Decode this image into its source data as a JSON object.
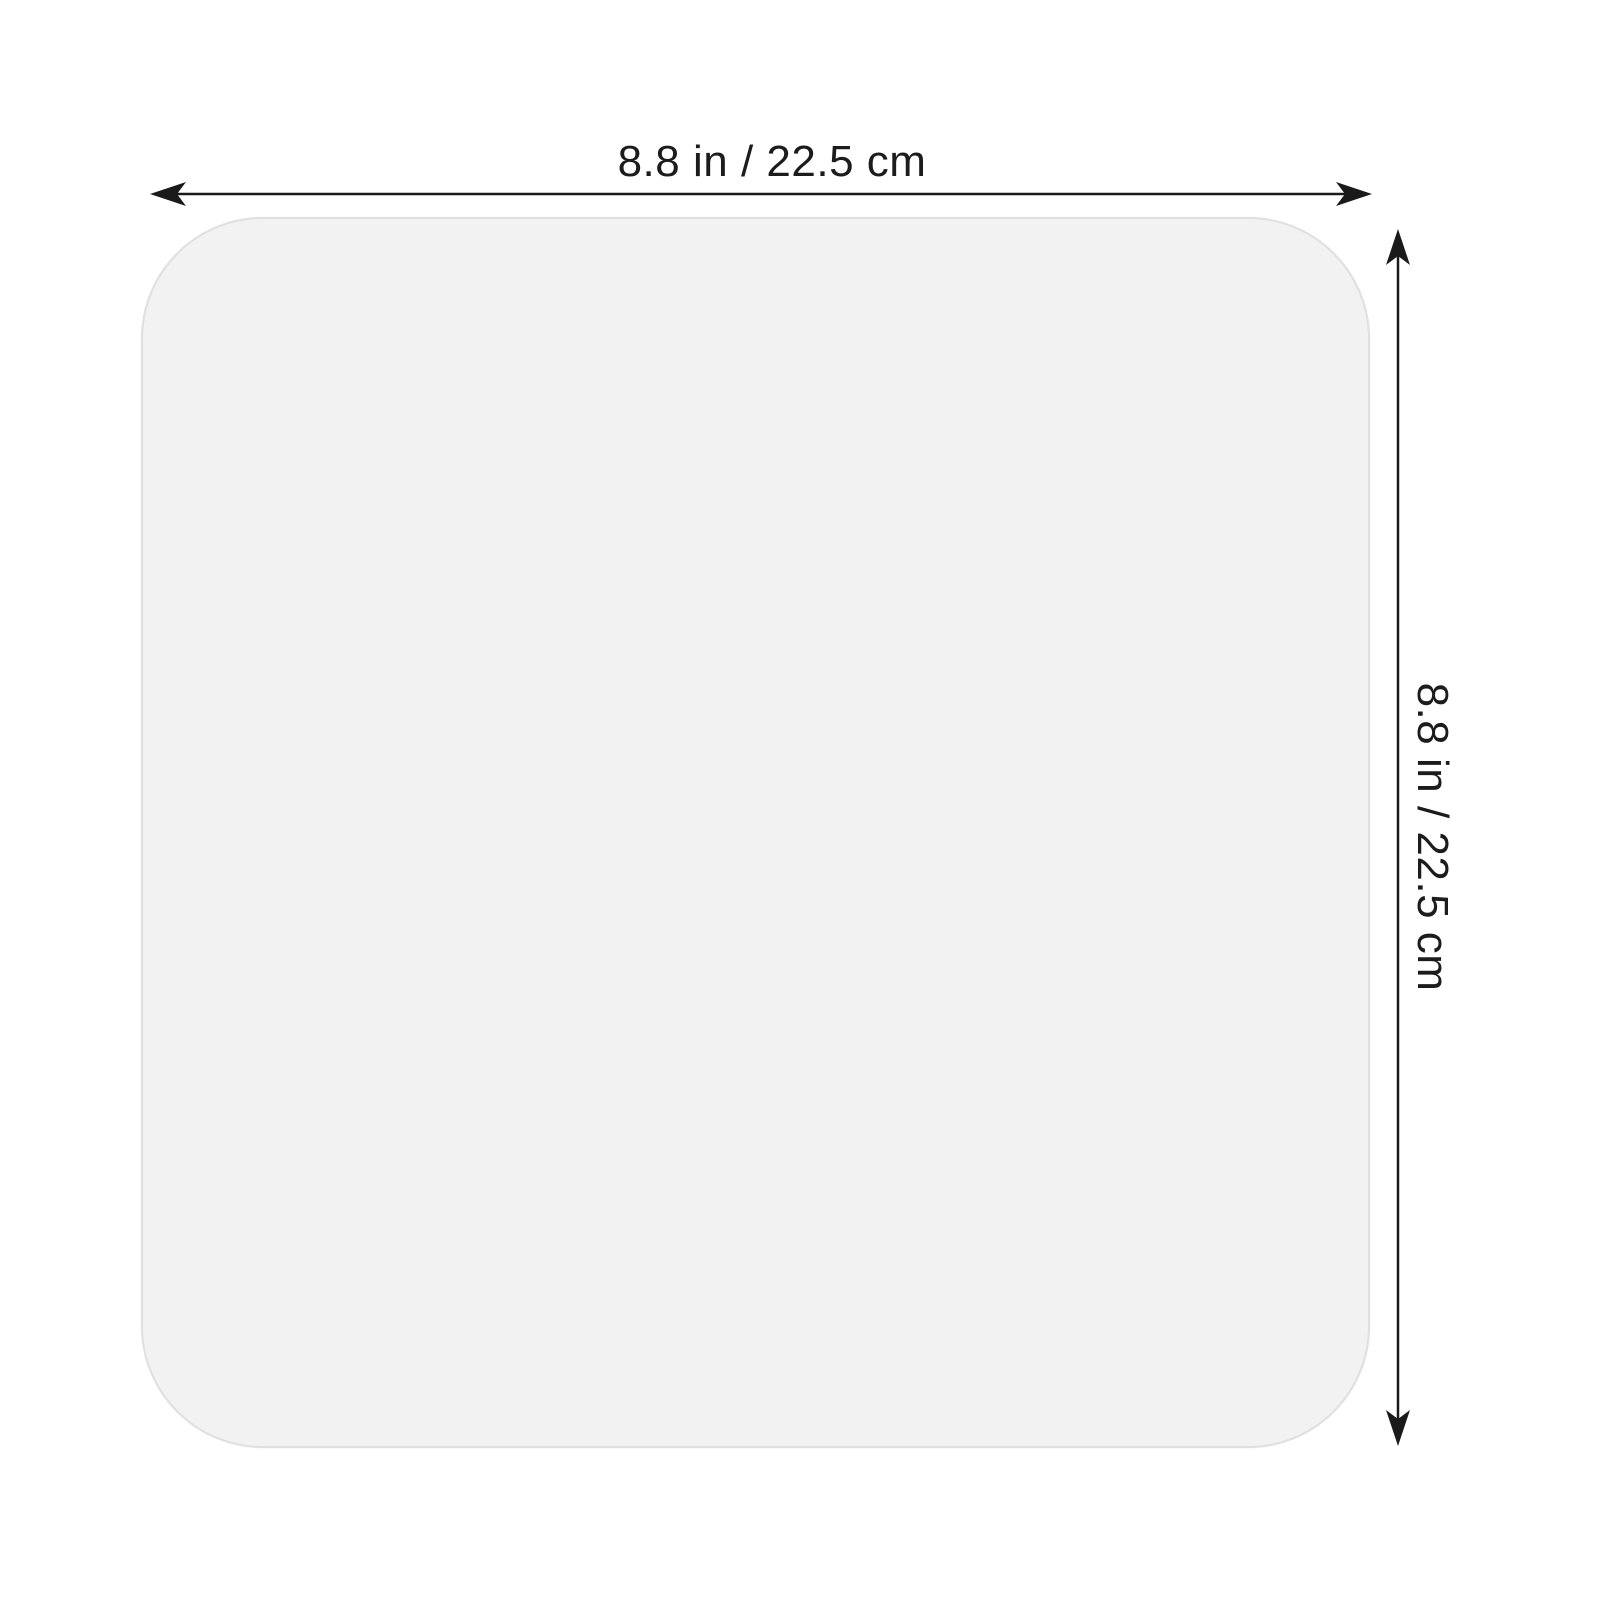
{
  "diagram": {
    "type": "product-dimension-diagram",
    "product": "square mat",
    "width_label": "8.8 in / 22.5 cm",
    "height_label": "8.8 in / 22.5 cm"
  },
  "colors": {
    "background": "#ffffff",
    "square_fill": "#f2f2f2",
    "square_border": "#e0e0e0",
    "dimension_line": "#1a1a1a",
    "label_text": "#1c1c1c"
  }
}
